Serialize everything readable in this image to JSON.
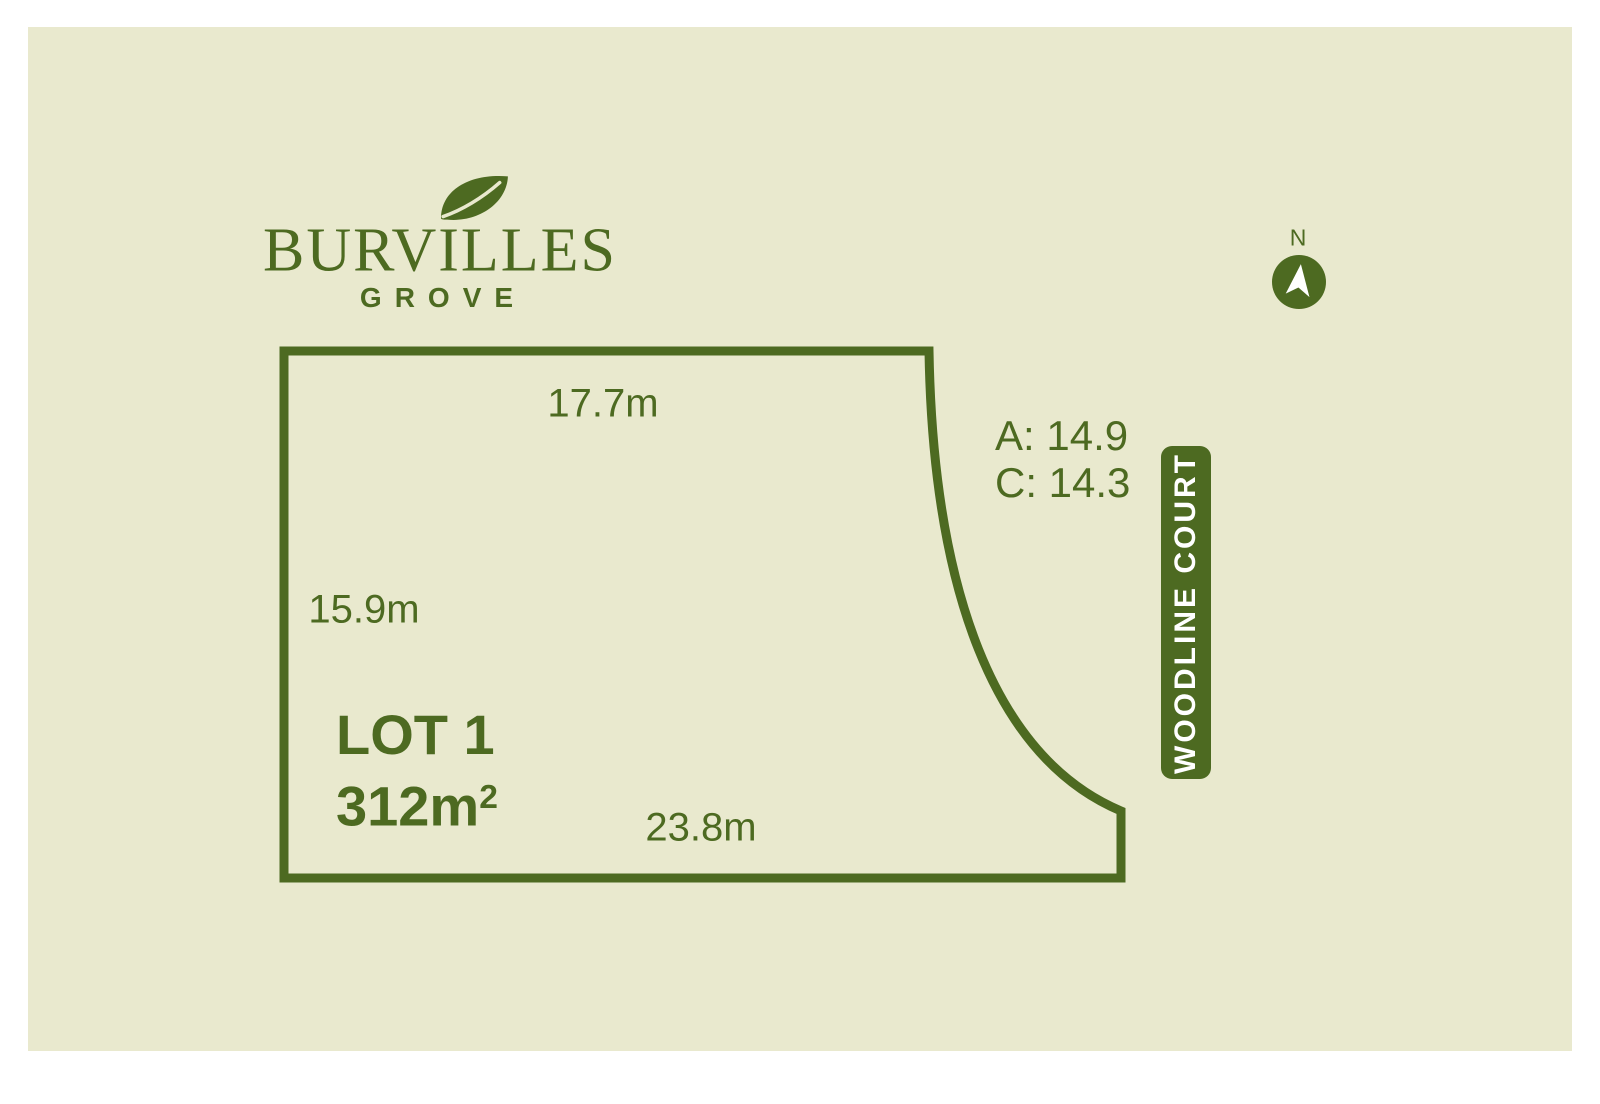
{
  "theme": {
    "page_bg": "#ffffff",
    "panel_bg": "#e9e9ce",
    "accent_green": "#4d6a21",
    "badge_text": "#ffffff"
  },
  "logo": {
    "name": "BURVILLES",
    "subtitle": "GROVE",
    "icon": "leaf-icon"
  },
  "compass": {
    "label": "N"
  },
  "lot": {
    "name": "LOT 1",
    "area_base": "312m",
    "area_sup": "2",
    "dimensions": {
      "top": "17.7m",
      "left": "15.9m",
      "bottom": "23.8m",
      "curve_line1": "A: 14.9",
      "curve_line2": "C: 14.3"
    }
  },
  "street": {
    "name": "WOODLINE COURT"
  }
}
